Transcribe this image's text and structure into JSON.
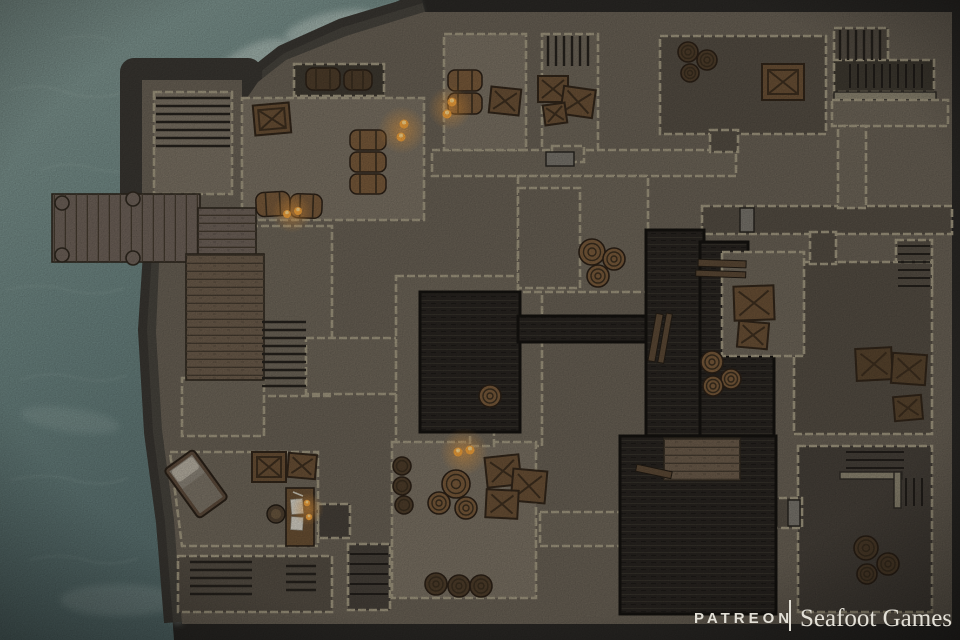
{
  "meta": {
    "type": "top-down battle map",
    "scene": "Seaside stone hideout with dock, sunken passages and storerooms"
  },
  "watermark": {
    "patreon": "PATREON",
    "divider": "|",
    "studio": "Seafoot Games"
  },
  "colors": {
    "rock-dark": "#2b2926",
    "rock-band": "#3a3732",
    "rock-band-light": "#4c4841",
    "water-light": "#869c96",
    "water-mid": "#6d8683",
    "water-deep": "#566c6c",
    "foam": "#ccd9d2",
    "wall-mass": "#6a6256",
    "stone-edge": "#a39a82",
    "floor-light": "#7b7264",
    "floor-mid": "#6f675a",
    "floor-dark": "#554e44",
    "floor-darker": "#47413a",
    "shadow-floor": "#3f3a31",
    "pit": "#282420",
    "pit-line": "#36322b",
    "wood": "#6f635a",
    "wood-stair": "#6d5d4c",
    "wood-dark": "#5d4a36",
    "barrel": "#7a5b3b",
    "barrel-dark": "#4f3e2b",
    "barrel-line": "#3a2e1f",
    "crate": "#6b5136",
    "crate-line": "#3e2f1f",
    "stone-slab": "#8d8672",
    "flame": "#f5a43c",
    "flame-core": "#ffd98a",
    "bed-frame": "#5e4c3c",
    "bed-sheet": "#8d867a",
    "pillow": "#b9b2a4",
    "blanket": "#7d7568",
    "desk": "#6b5134",
    "paper": "#d8d4c8",
    "chair": "#4f4030",
    "watermark": "#e3e0d7"
  },
  "map": {
    "environment": [
      "ocean with foam along rocky shore",
      "dark rock cliff band",
      "stone building complex",
      "sunken dark passages"
    ],
    "rooms": [
      {
        "id": "room-a",
        "label": "north-west stair room on promontory",
        "props": [
          "staircase"
        ]
      },
      {
        "id": "dock",
        "label": "wooden dock over water",
        "props": [
          "4 mooring posts"
        ]
      },
      {
        "id": "boardwalk",
        "label": "wooden boardwalk stairs descending south"
      },
      {
        "id": "room-b",
        "label": "warehouse hall",
        "props": [
          "crate",
          "3 stacked casks",
          "casks with torch",
          "wall torches",
          "dark alcove with casks"
        ]
      },
      {
        "id": "room-c",
        "label": "torch-lit store room",
        "props": [
          "2 casks",
          "crate",
          "2 torches"
        ]
      },
      {
        "id": "room-d",
        "label": "stair room",
        "props": [
          "staircase",
          "3 crates"
        ]
      },
      {
        "id": "room-e",
        "label": "dark hall",
        "props": [
          "3 barrels",
          "large crate"
        ]
      },
      {
        "id": "room-f",
        "label": "north-east stair corridor",
        "props": [
          "2 staircases",
          "stone ledge"
        ]
      },
      {
        "id": "plaza",
        "label": "central hall",
        "props": [
          "3 barrels"
        ]
      },
      {
        "id": "pit-central",
        "label": "sunken dark passage",
        "props": [
          "barrel at edge"
        ]
      },
      {
        "id": "platform",
        "label": "raised platform over pit",
        "props": [
          "2 crates",
          "3 barrels",
          "wooden beams"
        ]
      },
      {
        "id": "room-g",
        "label": "east room",
        "props": [
          "3 crates",
          "staircase"
        ]
      },
      {
        "id": "bedroom",
        "label": "south-west bedroom",
        "props": [
          "bed",
          "desk with papers and candles",
          "chair",
          "2 crates"
        ]
      },
      {
        "id": "storeroom",
        "label": "south storeroom",
        "props": [
          "3 barrels",
          "3 crates",
          "2 torches",
          "3 wall casks",
          "3 dark barrels"
        ]
      },
      {
        "id": "pit-south",
        "label": "sunken pit with wooden platform"
      },
      {
        "id": "room-j",
        "label": "south-east room",
        "props": [
          "2 staircases",
          "3 barrels"
        ]
      },
      {
        "id": "stairs-sw",
        "label": "south-west descending staircases"
      }
    ]
  }
}
